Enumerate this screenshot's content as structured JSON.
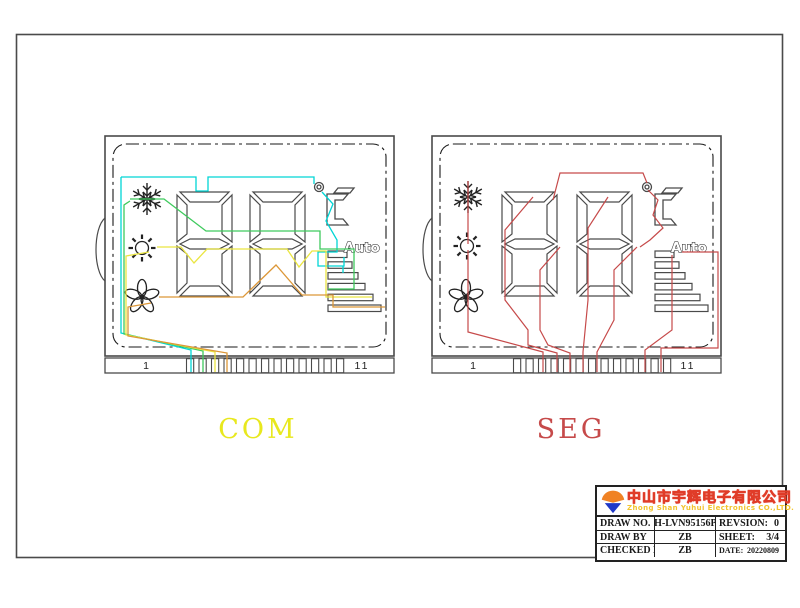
{
  "page": {
    "background": "#ffffff",
    "frame_color": "#4a4a4a"
  },
  "colors": {
    "outline": "#4a4a4a",
    "icon": "#222222",
    "com_label": "#e8e81e",
    "seg_label": "#c64a4a",
    "trace_cyan": "#00d5d5",
    "trace_green": "#3fca5d",
    "trace_yellow": "#eae542",
    "trace_orange": "#dc9738",
    "trace_red": "#c64a4a",
    "auto_text": "#ffffff",
    "auto_stroke": "#1a1a1a",
    "company_cn_fill": "#ffd42a",
    "company_cn_stroke": "#e03c28",
    "company_en": "#f2c52f",
    "logo_orange": "#f08224",
    "logo_blue": "#2039c8"
  },
  "icons": {
    "panel_icons": [
      "snowflake-icon",
      "sun-icon",
      "fan-icon",
      "degree-celsius-icon",
      "fan-speed-bars-icon"
    ]
  },
  "panels": [
    {
      "id": "com",
      "label": "COM",
      "auto_label": "Auto",
      "pin_label_left": "1",
      "pin_label_right": "11"
    },
    {
      "id": "seg",
      "label": "SEG",
      "auto_label": "Auto",
      "pin_label_left": "1",
      "pin_label_right": "11"
    }
  ],
  "title_block": {
    "company_cn": "中山市宇辉电子有限公司",
    "company_en": "Zhong Shan Yuhui Electronics CO.,LTD.",
    "draw_no_label": "DRAW NO.",
    "draw_no_value": "YH-LVN95156PA",
    "revision_label": "REVSION:",
    "revision_value": "0",
    "draw_by_label": "DRAW BY",
    "draw_by_value": "ZB",
    "sheet_label": "SHEET:",
    "sheet_value": "3/4",
    "checked_by_label": "CHECKED BY",
    "checked_by_value": "ZB",
    "date_label": "DATE:",
    "date_value": "20220809"
  }
}
